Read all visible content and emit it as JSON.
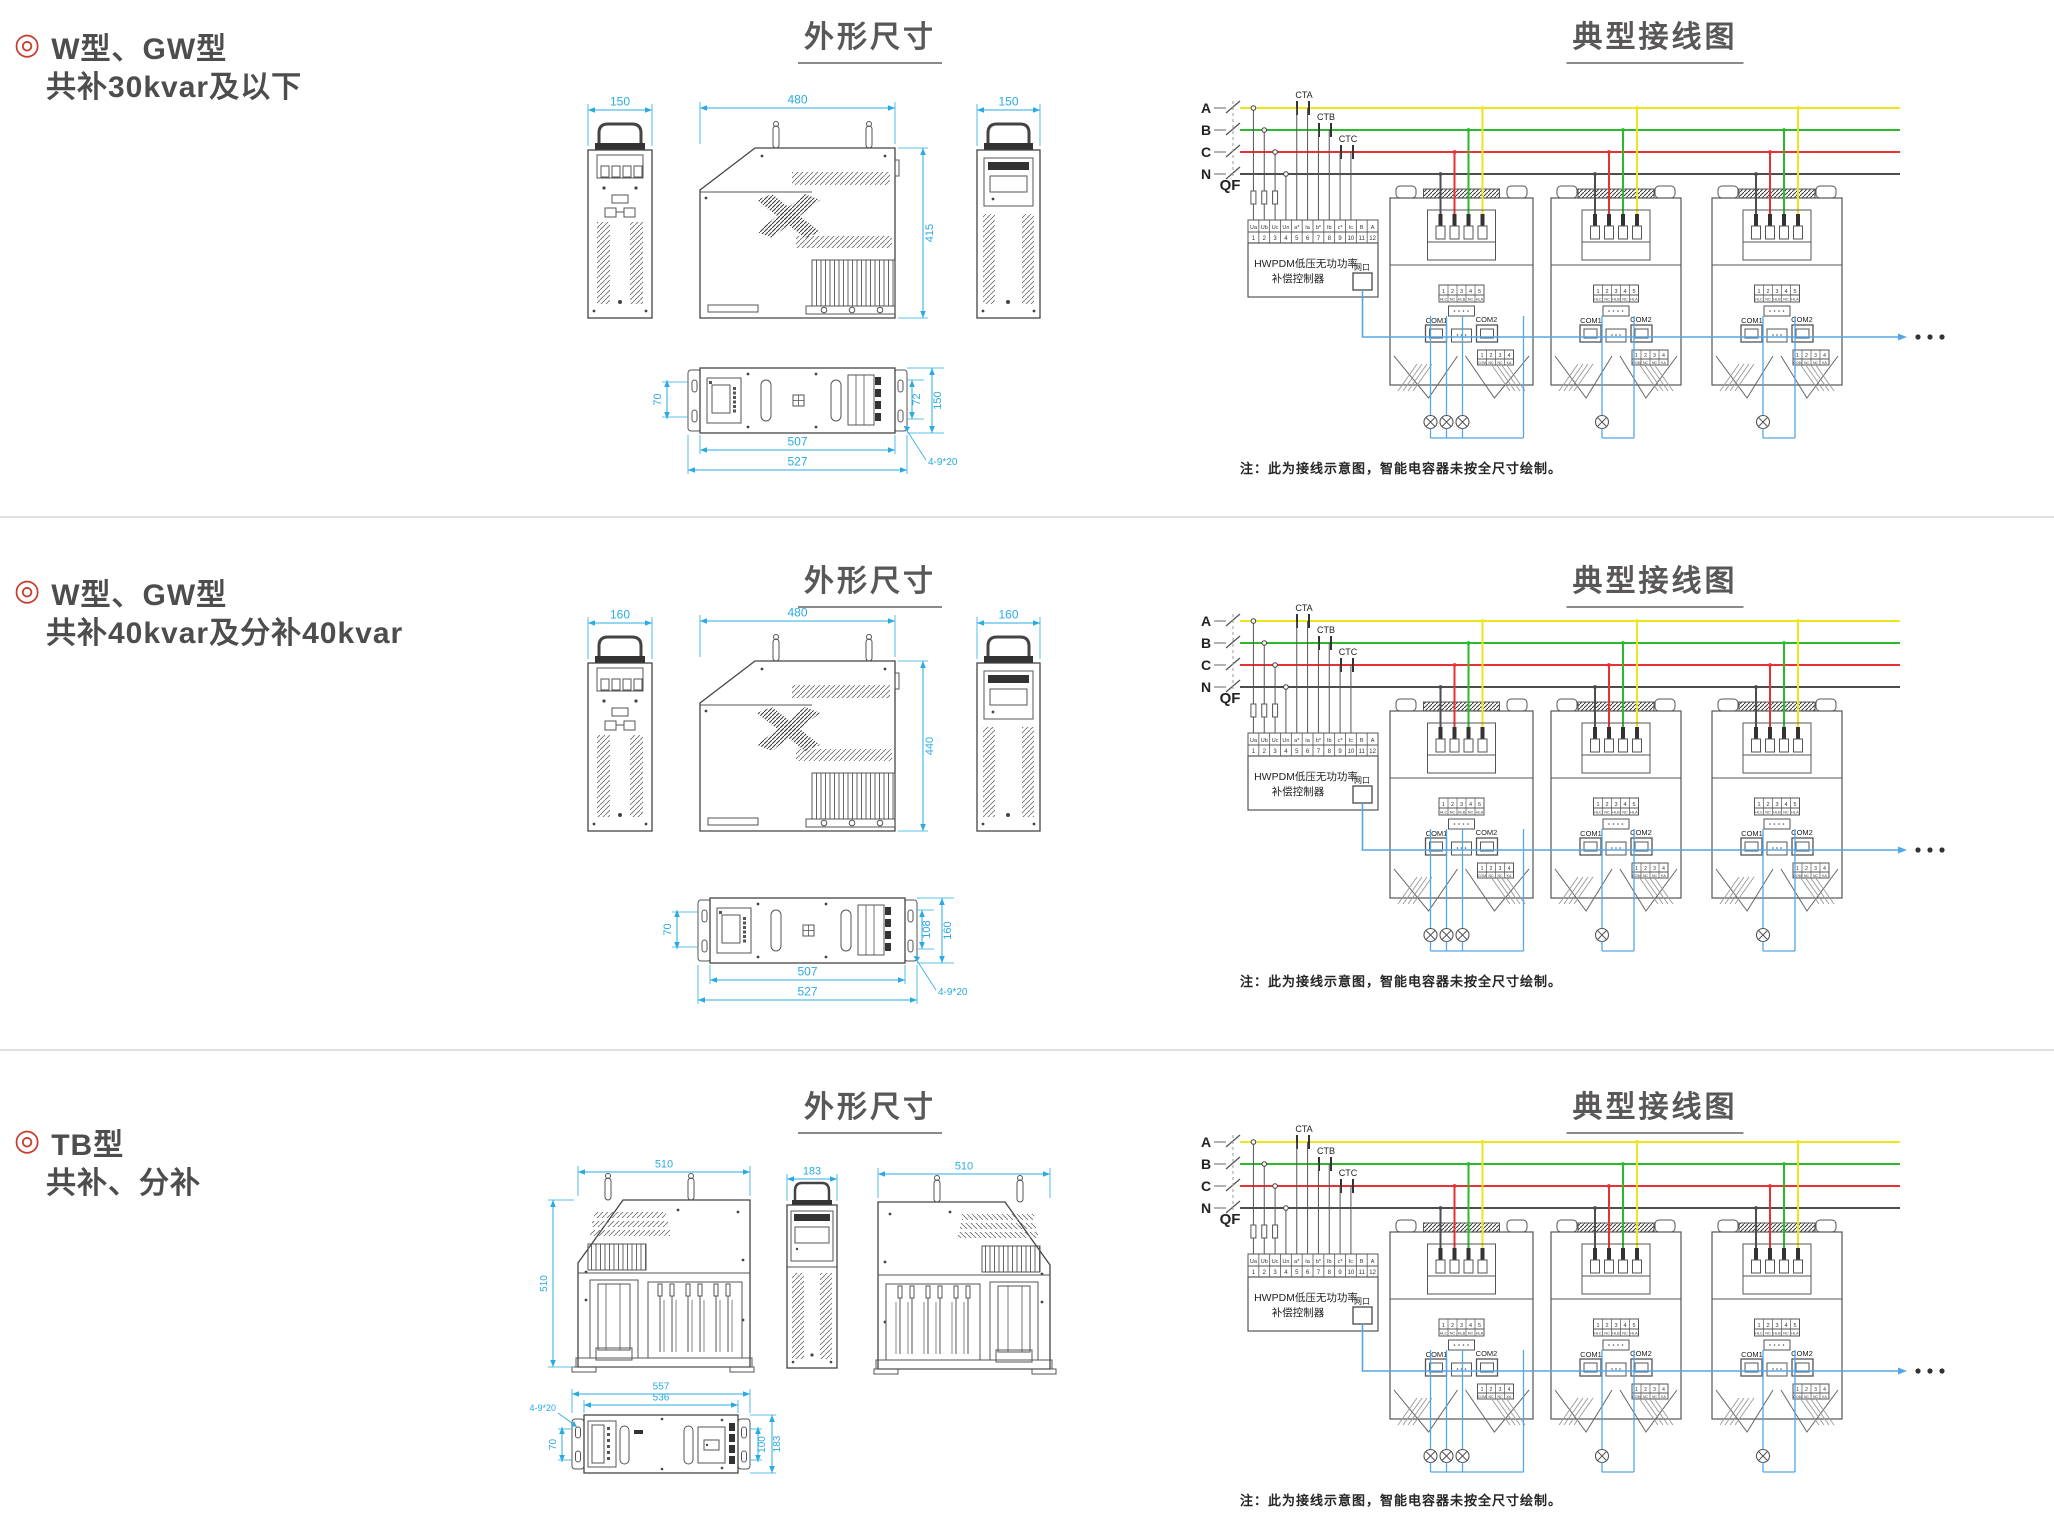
{
  "page": {
    "width": 2054,
    "height": 1532,
    "background": "#ffffff"
  },
  "colors": {
    "dim": "#29abe2",
    "outline": "#4a4a4a",
    "phase_a": "#efe51c",
    "phase_b": "#2db92d",
    "phase_c": "#e63232",
    "neutral": "#4d4d4d",
    "comm": "#55a6e8",
    "heading": "#595757",
    "label": "#4d4d4d",
    "bullet": "#c63d2f",
    "divider": "#e0e0e0"
  },
  "shared": {
    "dim_section_title": "外形尺寸",
    "wiring_section_title": "典型接线图",
    "wiring": {
      "phase_labels": [
        "A",
        "B",
        "C",
        "N"
      ],
      "breaker_label": "QF",
      "ct_labels": [
        "CTA",
        "CTB",
        "CTC"
      ],
      "controller_name_line1": "HWPDM低压无功功率",
      "controller_name_line2": "补偿控制器",
      "network_port_label": "网口",
      "terminal_labels": [
        "Ua",
        "Ub",
        "Uc",
        "Un",
        "a*",
        "Ia",
        "b*",
        "Ib",
        "c*",
        "Ic",
        "B",
        "A"
      ],
      "terminal_numbers": [
        "1",
        "2",
        "3",
        "4",
        "5",
        "6",
        "7",
        "8",
        "9",
        "10",
        "11",
        "12"
      ],
      "unit_terminal_numbers": [
        "1",
        "2",
        "3",
        "4",
        "5"
      ],
      "unit_terminal_labels": [
        "HLC",
        "NC",
        "HLB",
        "NC",
        "HLA"
      ],
      "unit_lower_terminal_numbers": [
        "1",
        "2",
        "3",
        "4"
      ],
      "unit_lower_terminal_labels": [
        "COM",
        "NC",
        "NC",
        "KA"
      ],
      "com1_label": "COM1",
      "com2_label": "COM2",
      "ellipsis_dots": 3,
      "note": "注：此为接线示意图，智能电容器未按全尺寸绘制。",
      "lamp_counts": [
        3,
        1,
        1
      ]
    }
  },
  "sections": [
    {
      "id": "w30",
      "bullet": "◎",
      "label_line1": "W型、GW型",
      "label_line2": "共补30kvar及以下",
      "drawing_type": "W",
      "dims": {
        "front_width": "150",
        "side_width": "480",
        "side_height": "415",
        "right_width": "150",
        "top_left": "70",
        "top_right_inner": "72",
        "top_right_outer": "150",
        "top_length_inner": "507",
        "top_length_outer": "527",
        "mounting_holes": "4-9*20"
      }
    },
    {
      "id": "w40",
      "bullet": "◎",
      "label_line1": "W型、GW型",
      "label_line2": "共补40kvar及分补40kvar",
      "drawing_type": "W",
      "dims": {
        "front_width": "160",
        "side_width": "480",
        "side_height": "440",
        "right_width": "160",
        "top_left": "70",
        "top_right_inner": "108",
        "top_right_outer": "160",
        "top_length_inner": "507",
        "top_length_outer": "527",
        "mounting_holes": "4-9*20"
      }
    },
    {
      "id": "tb",
      "bullet": "◎",
      "label_line1": "TB型",
      "label_line2": "共补、分补",
      "drawing_type": "TB",
      "dims": {
        "side1_width": "510",
        "side1_height": "510",
        "front_width": "183",
        "side2_width": "510",
        "top_length_outer": "557",
        "top_length_inner": "536",
        "top_left": "70",
        "top_right_inner": "100",
        "top_right_outer": "183",
        "mounting_holes": "4-9*20"
      }
    }
  ]
}
